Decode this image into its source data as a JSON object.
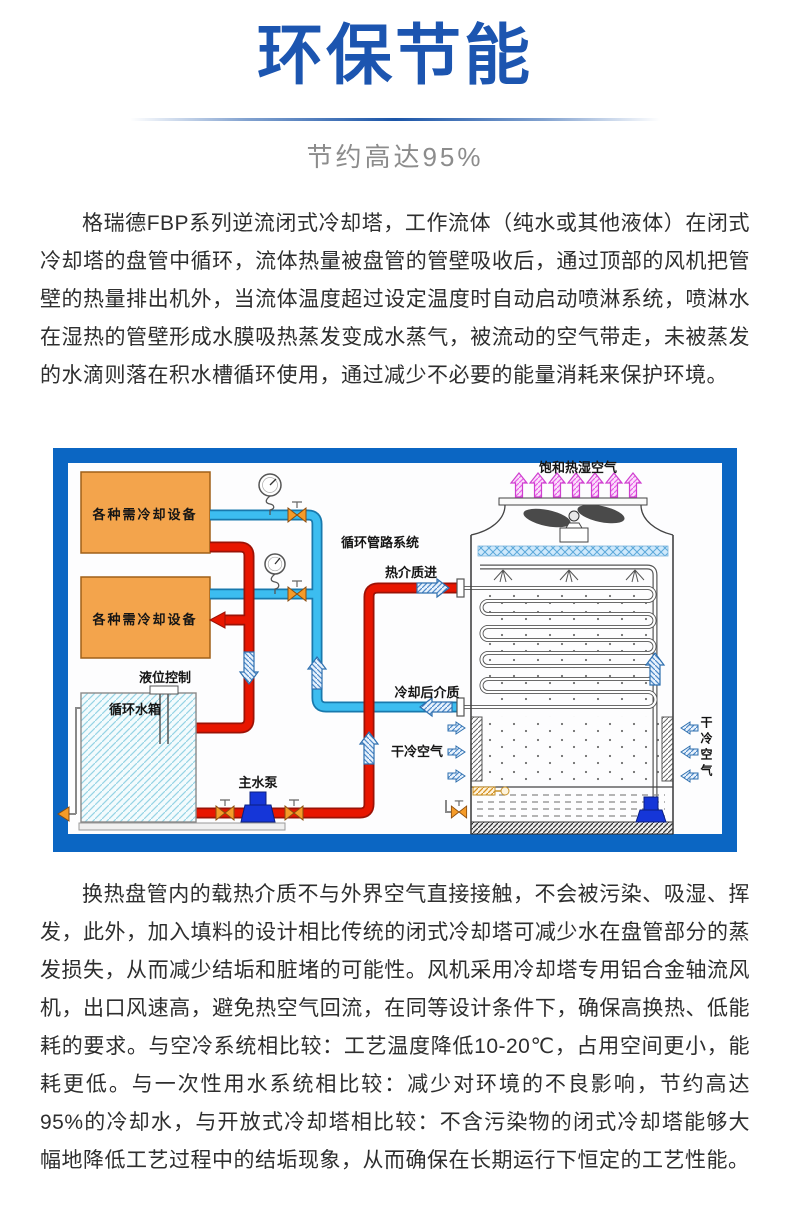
{
  "page": {
    "title": "环保节能",
    "subtitle": "节约高达95%",
    "paragraph1": "格瑞德FBP系列逆流闭式冷却塔，工作流体（纯水或其他液体）在闭式冷却塔的盘管中循环，流体热量被盘管的管壁吸收后，通过顶部的风机把管壁的热量排出机外，当流体温度超过设定温度时自动启动喷淋系统，喷淋水在湿热的管壁形成水膜吸热蒸发变成水蒸气，被流动的空气带走，未被蒸发的水滴则落在积水槽循环使用，通过减少不必要的能量消耗来保护环境。",
    "paragraph2": "换热盘管内的载热介质不与外界空气直接接触，不会被污染、吸湿、挥发，此外，加入填料的设计相比传统的闭式冷却塔可减少水在盘管部分的蒸发损失，从而减少结垢和脏堵的可能性。风机采用冷却塔专用铝合金轴流风机，出口风速高，避免热空气回流，在同等设计条件下，确保高换热、低能耗的要求。与空冷系统相比较：工艺温度降低10-20℃，占用空间更小，能耗更低。与一次性用水系统相比较：减少对环境的不良影响，节约高达95%的冷却水，与开放式冷却塔相比较：不含污染物的闭式冷却塔能够大幅地降低工艺过程中的结垢现象，从而确保在长期运行下恒定的工艺性能。"
  },
  "diagram": {
    "labels": {
      "equipment1": "各种需冷却设备",
      "equipment2": "各种需冷却设备",
      "level_control": "液位控制",
      "water_tank": "循环水箱",
      "main_pump": "主水泵",
      "pipe_system": "循环管路系统",
      "hot_medium_in": "热介质进",
      "cooled_medium": "冷却后介质",
      "dry_air_left": "干冷空气",
      "dry_air_right": "干冷空气",
      "saturated_air": "饱和热湿空气"
    },
    "colors": {
      "frame": "#0b66c3",
      "hot_pipe": "#e81600",
      "cold_pipe": "#3cbdf0",
      "equipment_box": "#f3a44c",
      "pump": "#1536d8",
      "exhaust_arrow": "#cf3fcf"
    }
  },
  "theme": {
    "title_color": "#1c55b0",
    "subtitle_color": "#8c8c8c",
    "text_color": "#2e2e2e"
  }
}
